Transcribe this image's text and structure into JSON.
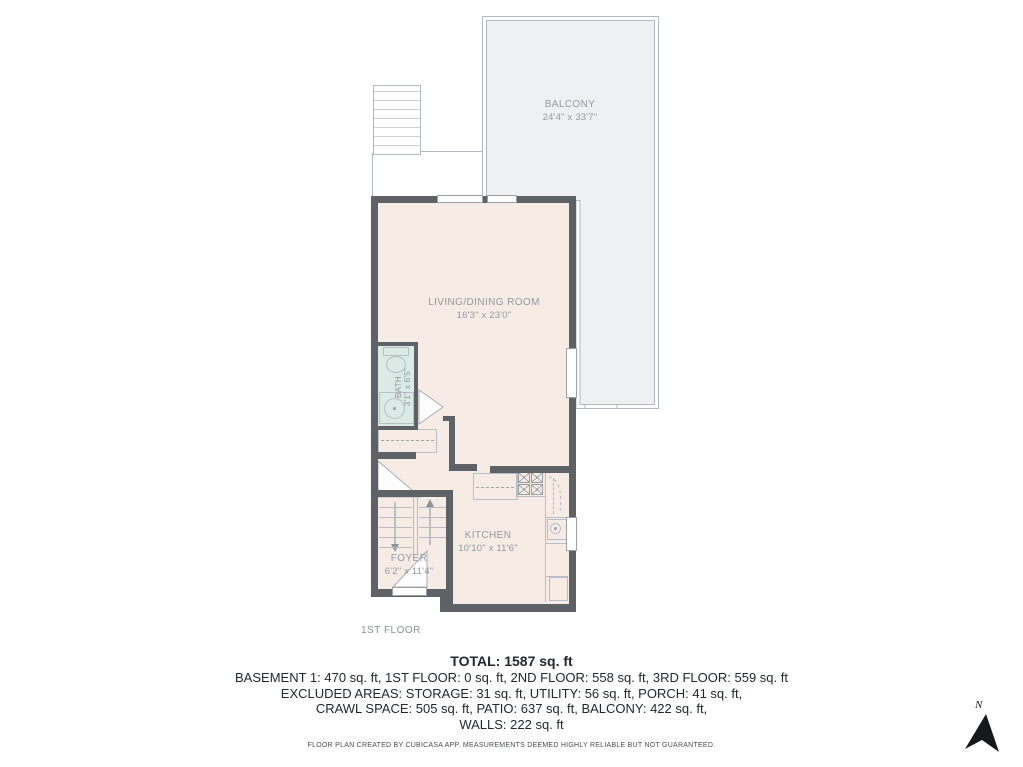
{
  "plan": {
    "floor_label": "1ST FLOOR",
    "rooms": {
      "balcony": {
        "name": "BALCONY",
        "dims": "24'4\" x 33'7\""
      },
      "living": {
        "name": "LIVING/DINING ROOM",
        "dims": "16'3\" x 23'0\""
      },
      "bath": {
        "name": "BATH",
        "dims": "3'1\" x 6'5\""
      },
      "kitchen": {
        "name": "KITCHEN",
        "dims": "10'10\" x 11'6\""
      },
      "foyer": {
        "name": "FOYER",
        "dims": "6'2\" x 11'4\""
      }
    },
    "compass": {
      "label": "N"
    }
  },
  "summary": {
    "total": "TOTAL: 1587 sq. ft",
    "lines": [
      "BASEMENT 1: 470 sq. ft, 1ST FLOOR: 0 sq. ft, 2ND FLOOR: 558 sq. ft, 3RD FLOOR: 559 sq. ft",
      "EXCLUDED AREAS: STORAGE: 31 sq. ft, UTILITY: 56 sq. ft, PORCH: 41 sq. ft,",
      "CRAWL SPACE: 505 sq. ft, PATIO: 637 sq. ft, BALCONY: 422 sq. ft,",
      "WALLS: 222 sq. ft"
    ]
  },
  "footer": "FLOOR PLAN CREATED BY CUBICASA APP. MEASUREMENTS DEEMED HIGHLY RELIABLE BUT NOT GUARANTEED.",
  "colors": {
    "wall": "#5e6267",
    "floor": "#f7ece5",
    "bath_floor": "#dceae6",
    "balcony_fill": "#eff0f2",
    "label_text": "#94999f",
    "summary_text": "#23272f"
  }
}
